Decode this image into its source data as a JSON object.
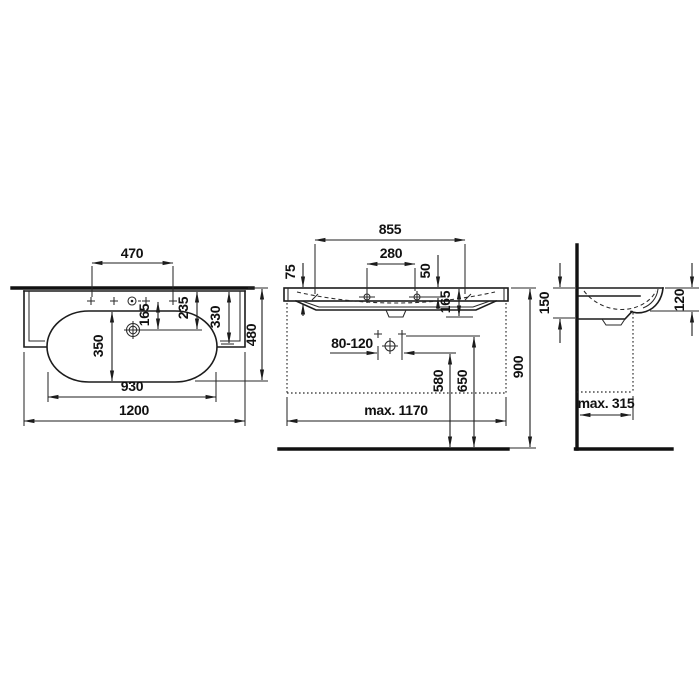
{
  "drawing": {
    "kind": "washbasin technical dimension drawing",
    "line_color": "#1c1c1c",
    "background": "#ffffff"
  },
  "views": {
    "top": {
      "d470": "470",
      "d165": "165",
      "d235": "235",
      "d330": "330",
      "d350": "350",
      "d930": "930",
      "d1200": "1200",
      "d480": "480"
    },
    "front": {
      "d855": "855",
      "d280": "280",
      "d75": "75",
      "d50": "50",
      "d165": "165",
      "d80_120": "80-120",
      "d580": "580",
      "d650": "650",
      "d900": "900",
      "dmax1170": "max. 1170"
    },
    "side": {
      "d150": "150",
      "d120": "120",
      "dmax315": "max. 315"
    }
  }
}
